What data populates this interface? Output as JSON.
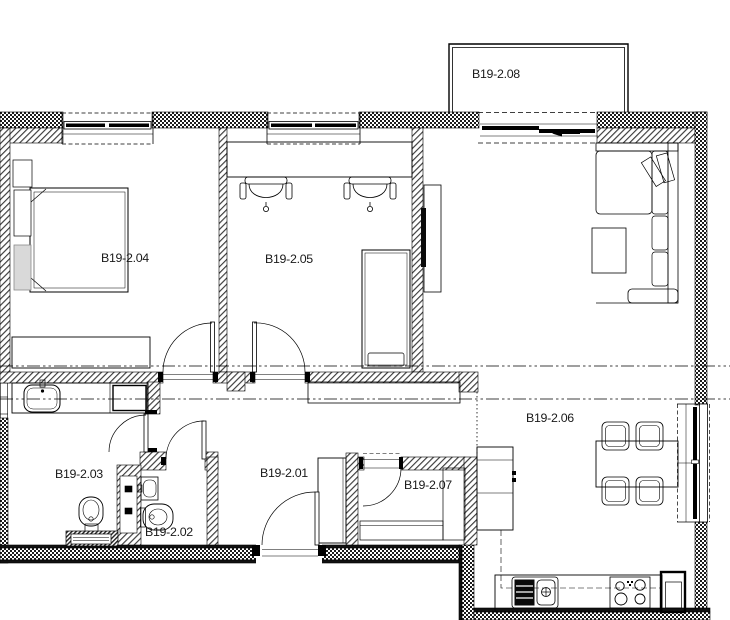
{
  "plan": {
    "title": "Apartment floor plan B19-2",
    "rooms": [
      {
        "id": "hall",
        "label": "B19-2.01"
      },
      {
        "id": "wc",
        "label": "B19-2.02"
      },
      {
        "id": "bathroom",
        "label": "B19-2.03"
      },
      {
        "id": "bedroom",
        "label": "B19-2.04"
      },
      {
        "id": "office",
        "label": "B19-2.05"
      },
      {
        "id": "living",
        "label": "B19-2.06"
      },
      {
        "id": "storage",
        "label": "B19-2.07"
      },
      {
        "id": "balcony",
        "label": "B19-2.08"
      }
    ],
    "colors": {
      "line": "#000000",
      "background": "#ffffff",
      "furniture_gray": "#d9d9d9"
    }
  }
}
